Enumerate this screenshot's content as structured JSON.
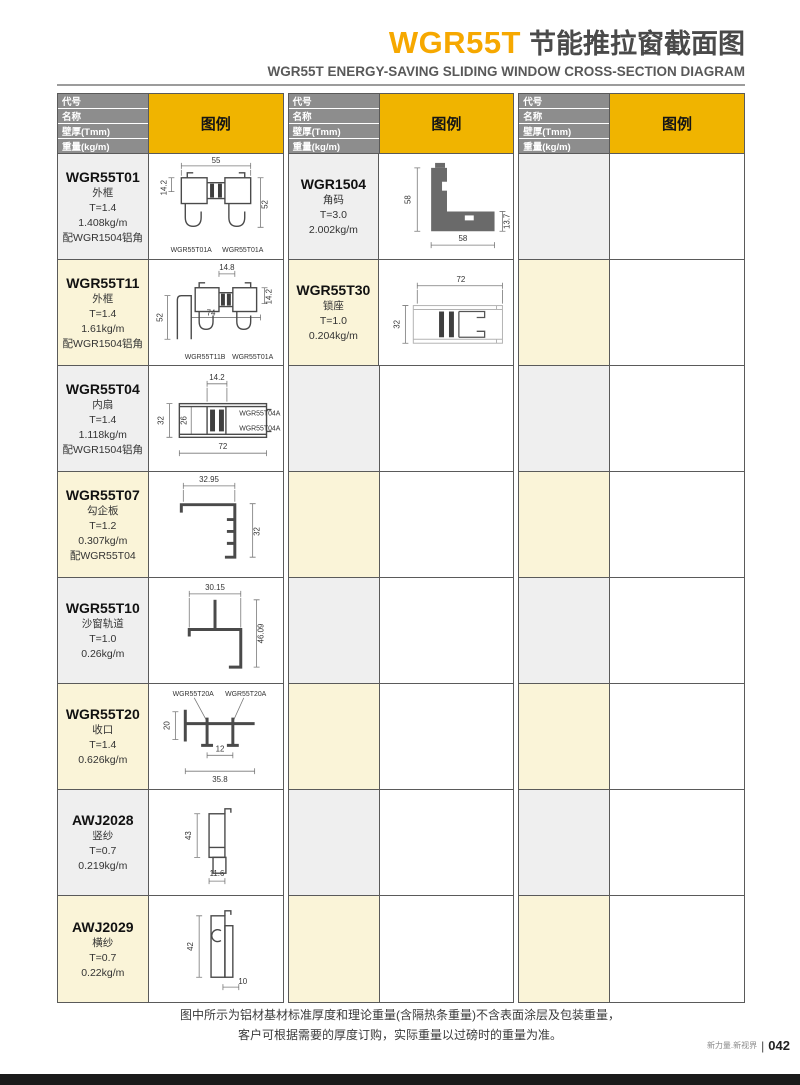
{
  "header": {
    "code": "WGR55T",
    "title_cn": "节能推拉窗截面图",
    "subtitle": "WGR55T ENERGY-SAVING SLIDING WINDOW CROSS-SECTION DIAGRAM"
  },
  "table_head": {
    "rows": [
      "代号",
      "名称",
      "壁厚(Tmm)",
      "重量(kg/m)"
    ],
    "legend": "图例"
  },
  "profiles": {
    "t01": {
      "code": "WGR55T01",
      "name": "外框",
      "thickness": "T=1.4",
      "weight": "1.408kg/m",
      "match": "配WGR1504铝角",
      "dims": {
        "top": "55",
        "left": "14.2",
        "right": "52"
      },
      "labels": {
        "bl": "WGR55T01A",
        "br": "WGR55T01A"
      }
    },
    "t11": {
      "code": "WGR55T11",
      "name": "外框",
      "thickness": "T=1.4",
      "weight": "1.61kg/m",
      "match": "配WGR1504铝角",
      "dims": {
        "top": "14.8",
        "left": "52",
        "right": "14.2",
        "mid": "74"
      },
      "labels": {
        "bl": "WGR55T11B",
        "br": "WGR55T01A"
      }
    },
    "t04": {
      "code": "WGR55T04",
      "name": "内扇",
      "thickness": "T=1.4",
      "weight": "1.118kg/m",
      "match": "配WGR1504铝角",
      "dims": {
        "top": "14.2",
        "left": "32",
        "inner": "26",
        "bottom": "72"
      },
      "labels": {
        "r1": "WGR55T04A",
        "r2": "WGR55T04A"
      }
    },
    "t07": {
      "code": "WGR55T07",
      "name": "勾企板",
      "thickness": "T=1.2",
      "weight": "0.307kg/m",
      "match": "配WGR55T04",
      "dims": {
        "top": "32.95",
        "right": "32"
      }
    },
    "t10": {
      "code": "WGR55T10",
      "name": "沙窗轨道",
      "thickness": "T=1.0",
      "weight": "0.26kg/m",
      "dims": {
        "top": "30.15",
        "right": "46.09"
      }
    },
    "t20": {
      "code": "WGR55T20",
      "name": "收口",
      "thickness": "T=1.4",
      "weight": "0.626kg/m",
      "dims": {
        "left": "20",
        "mid": "12",
        "bottom": "35.8"
      },
      "labels": {
        "tl": "WGR55T20A",
        "tr": "WGR55T20A"
      }
    },
    "a28": {
      "code": "AWJ2028",
      "name": "竖纱",
      "thickness": "T=0.7",
      "weight": "0.219kg/m",
      "dims": {
        "left": "43",
        "bottom": "11.6"
      }
    },
    "a29": {
      "code": "AWJ2029",
      "name": "横纱",
      "thickness": "T=0.7",
      "weight": "0.22kg/m",
      "dims": {
        "left": "42",
        "bottom": "10"
      }
    },
    "c1504": {
      "code": "WGR1504",
      "name": "角码",
      "thickness": "T=3.0",
      "weight": "2.002kg/m",
      "dims": {
        "left": "58",
        "right": "13.7",
        "bottom": "58"
      }
    },
    "t30": {
      "code": "WGR55T30",
      "name": "锁座",
      "thickness": "T=1.0",
      "weight": "0.204kg/m",
      "dims": {
        "top": "72",
        "left": "32"
      }
    }
  },
  "footer": {
    "note1": "图中所示为铝材基材标准厚度和理论重量(含隔热条重量)不含表面涂层及包装重量，",
    "note2": "客户可根据需要的厚度订购，实际重量以过磅时的重量为准。",
    "brand": "新力量.新视界",
    "page": "042"
  },
  "colors": {
    "accent_orange": "#F6A800",
    "legend_yellow": "#F0B400",
    "header_gray": "#8D8D8D",
    "row_gray": "#EFEFEF",
    "row_cream": "#FAF4D8"
  }
}
